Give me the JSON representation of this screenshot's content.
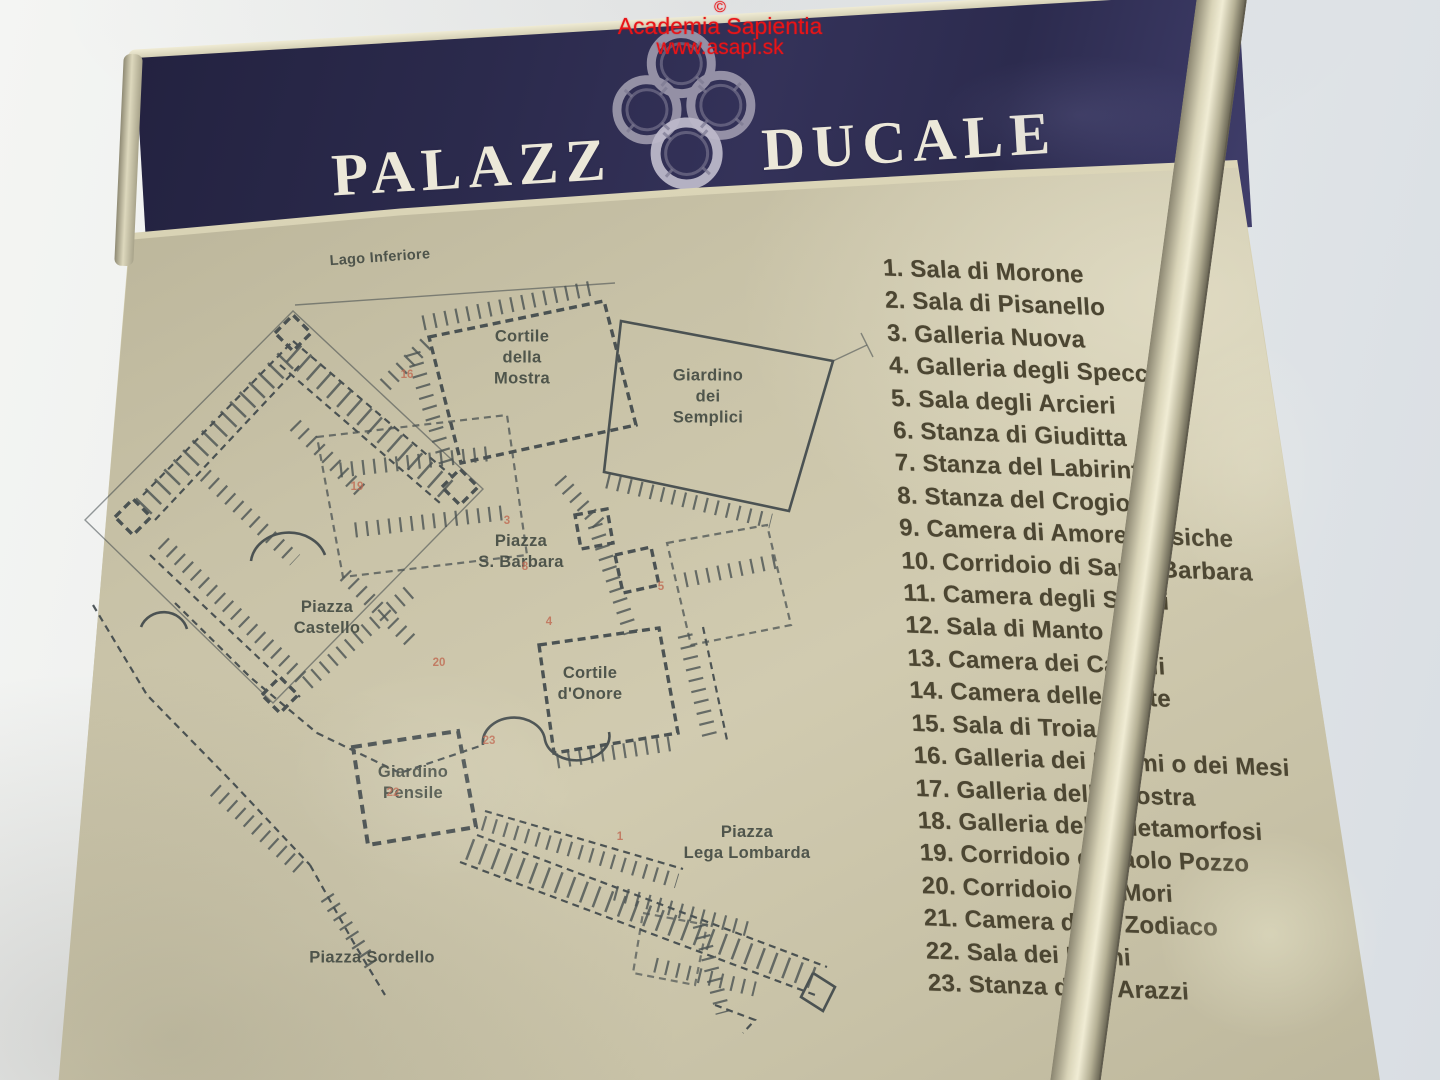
{
  "watermark": {
    "copyright": "©",
    "org": "Academia Sapientia",
    "url": "www.asapi.sk",
    "color": "#e81417"
  },
  "banner": {
    "title_part1": "PALAZZ",
    "title_part2": "DUCALE",
    "logo": "four-interlocked-gonzaga-rings",
    "background": "#2e2d50",
    "text_color": "#ece8d9"
  },
  "panel": {
    "background": "#c8c2a7",
    "frame_color": "#d0cbae"
  },
  "map": {
    "ink_color": "#3a4347",
    "red_mark_color": "#c06a52",
    "area_labels": {
      "lago_inferiore": "Lago Inferiore",
      "cortile_mostra": "Cortile\ndella\nMostra",
      "giardino_semplici": "Giardino\ndei\nSemplici",
      "piazza_s_barbara": "Piazza\nS. Barbara",
      "piazza_castello": "Piazza\nCastello",
      "cortile_onore": "Cortile\nd'Onore",
      "giardino_pensile": "Giardino\nPensile",
      "piazza_lega_lombarda": "Piazza\nLega Lombarda",
      "piazza_sordello": "Piazza Sordello"
    },
    "room_marks": [
      "16",
      "19",
      "3",
      "8",
      "4",
      "5",
      "20",
      "23",
      "22",
      "1"
    ]
  },
  "legend": {
    "text_color": "#4c4632",
    "items": [
      "1. Sala di Morone",
      "2. Sala di Pisanello",
      "3. Galleria Nuova",
      "4. Galleria degli Specchi",
      "5. Sala degli Arcieri",
      "6. Stanza di Giuditta",
      "7. Stanza del Labirinto",
      "8. Stanza del Crogiolo",
      "9. Camera di Amore e Psiche",
      "10. Corridoio di Santa Barbara",
      "11. Camera degli Sposi",
      "12. Sala di Manto",
      "13. Camera dei Cavalli",
      "14. Camera delle Teste",
      "15. Sala di Troia",
      "16. Galleria dei Marmi o dei Mesi",
      "17. Galleria della Mostra",
      "18. Galleria delle Metamorfosi",
      "19. Corridoio di Paolo Pozzo",
      "20. Corridoio dei Mori",
      "21. Camera dello Zodiaco",
      "22. Sala dei Fiumi",
      "23. Stanza degli Arazzi"
    ]
  }
}
